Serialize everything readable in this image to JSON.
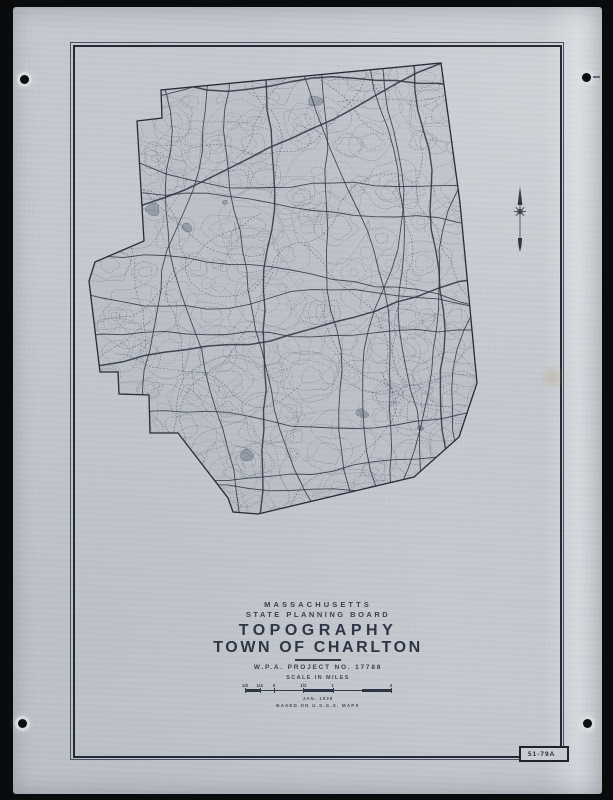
{
  "artifact": {
    "background_color": "#0a0b0d",
    "paper_color": "#c5c9cf",
    "ink_color": "#2e3544",
    "contour_color": "#4f5769",
    "road_color": "#2b3240",
    "stream_color": "#3f4a60"
  },
  "title_block": {
    "state": "MASSACHUSETTS",
    "board": "STATE  PLANNING  BOARD",
    "title": "TOPOGRAPHY",
    "town": "TOWN OF CHARLTON",
    "project": "W.P.A.  PROJECT  NO.  17788",
    "scale_caption": "SCALE  IN  MILES",
    "date": "JAN. 1939",
    "credit": "BASED  ON  U.S.G.S.  MAPS"
  },
  "scale_bar": {
    "ticks": [
      {
        "label": "1/2",
        "pos": 0
      },
      {
        "label": "1/4",
        "pos": 0.1
      },
      {
        "label": "0",
        "pos": 0.2
      },
      {
        "label": "1/2",
        "pos": 0.4
      },
      {
        "label": "1",
        "pos": 0.6
      },
      {
        "label": "2",
        "pos": 1
      }
    ],
    "filled_segments": [
      [
        0,
        0.1
      ],
      [
        0.4,
        0.6
      ],
      [
        0.8,
        1
      ]
    ]
  },
  "sheet_number": "51-79A",
  "compass": {
    "icon": "north-arrow"
  },
  "map": {
    "boundary_points": [
      [
        137,
        121
      ],
      [
        162,
        118
      ],
      [
        161,
        90
      ],
      [
        441,
        63
      ],
      [
        460,
        203
      ],
      [
        477,
        383
      ],
      [
        459,
        437
      ],
      [
        414,
        477
      ],
      [
        258,
        514
      ],
      [
        233,
        512
      ],
      [
        228,
        498
      ],
      [
        178,
        433
      ],
      [
        150,
        433
      ],
      [
        149,
        395
      ],
      [
        119,
        394
      ],
      [
        118,
        372
      ],
      [
        100,
        372
      ],
      [
        89,
        281
      ],
      [
        95,
        262
      ],
      [
        144,
        241
      ]
    ]
  }
}
